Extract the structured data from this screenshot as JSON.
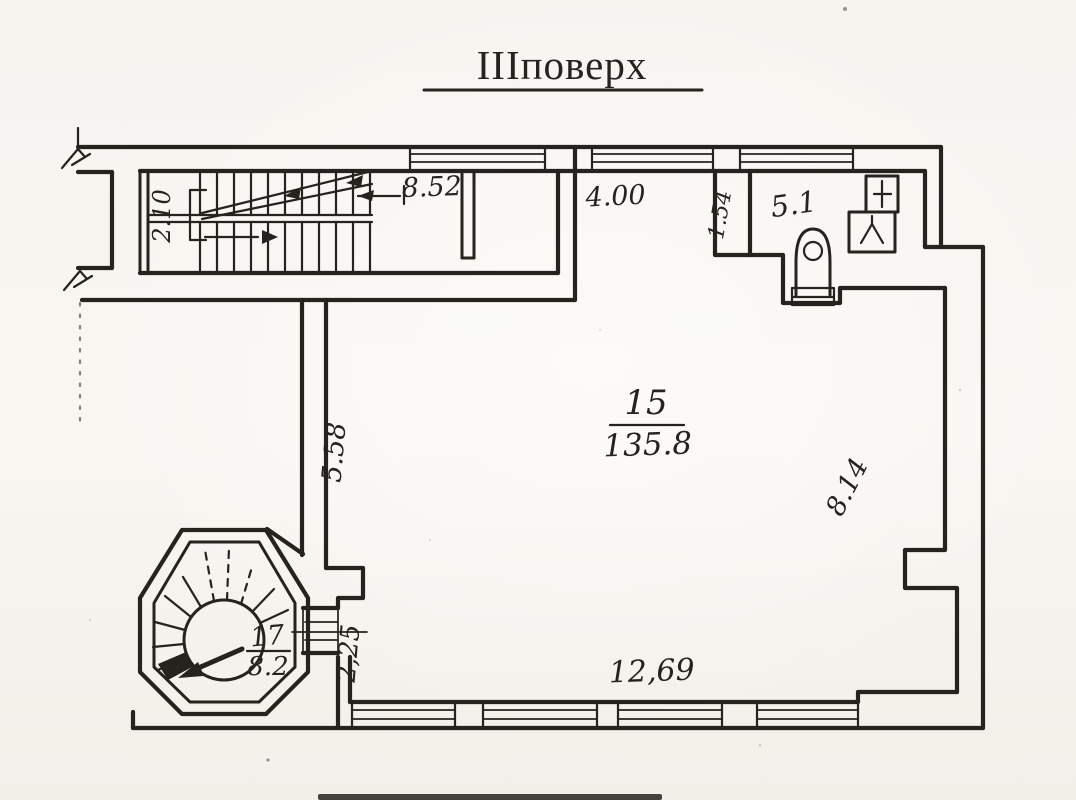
{
  "colors": {
    "ink": "#26221d",
    "paper": "#f7f5f0"
  },
  "title": {
    "text": "ІІІповерх"
  },
  "floor_plan": {
    "rooms": {
      "main_room": {
        "number": "15",
        "area": "135.8"
      },
      "tower_room": {
        "number": "17",
        "area": "8.2"
      },
      "wc_room": {
        "area": "5.1"
      }
    },
    "dimensions": {
      "stair_flight_width": "2.10",
      "stair_hall_length": "8.52",
      "north_wall_segment": "4.00",
      "entry_wall_stub": "1.54",
      "west_wall": "5.58",
      "east_wall": "8.14",
      "tower_passage": "2,25",
      "south_wall": "12,69"
    },
    "symbols": [
      "staircase",
      "spiral-staircase",
      "toilet",
      "sink",
      "shower-tray",
      "window",
      "wall-break-mark"
    ]
  }
}
